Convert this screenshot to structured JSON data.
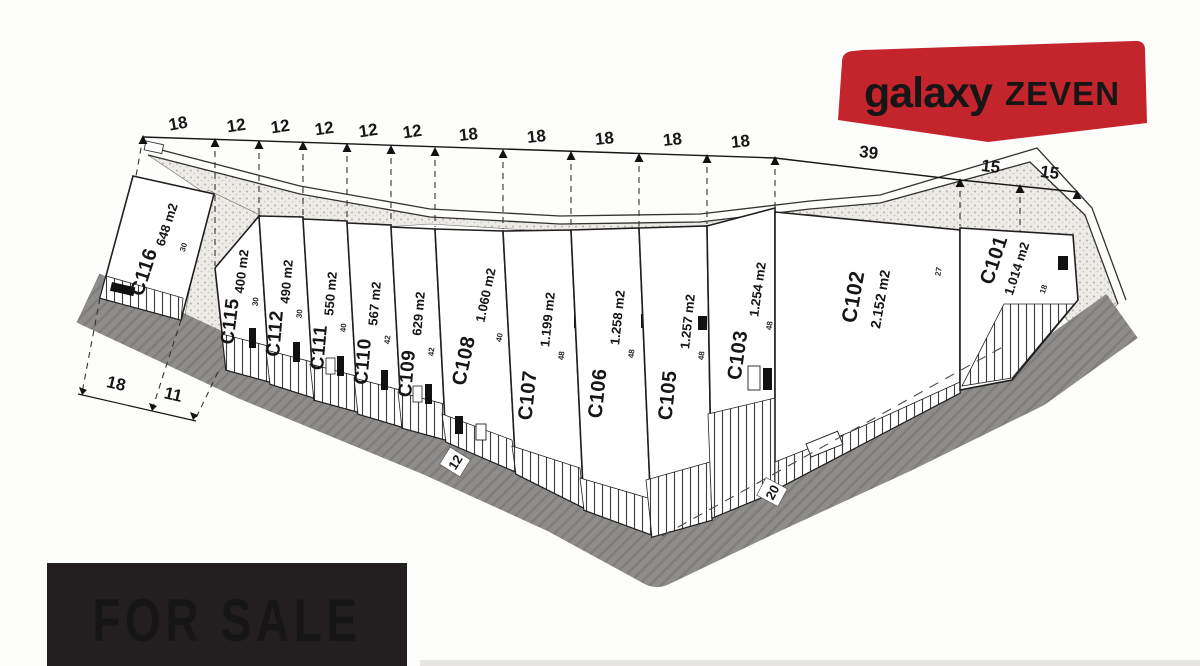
{
  "brand": {
    "name_primary": "galaxy",
    "name_secondary": "ZEVEN"
  },
  "sale_banner": {
    "text": "FOR SALE"
  },
  "dimensions": {
    "top": [
      "18",
      "12",
      "12",
      "12",
      "12",
      "12",
      "18",
      "18",
      "18",
      "18",
      "18",
      "39",
      "15",
      "15"
    ],
    "bottom_left": [
      "18",
      "11"
    ],
    "road": [
      "12",
      "20"
    ]
  },
  "lots": [
    {
      "id": "C116",
      "area": "648 m2",
      "frontage": "30"
    },
    {
      "id": "C115",
      "area": "400 m2",
      "frontage": "30"
    },
    {
      "id": "C112",
      "area": "490 m2",
      "frontage": "30"
    },
    {
      "id": "C111",
      "area": "550 m2",
      "frontage": "40"
    },
    {
      "id": "C110",
      "area": "567 m2",
      "frontage": "42"
    },
    {
      "id": "C109",
      "area": "629 m2",
      "frontage": "42"
    },
    {
      "id": "C108",
      "area": "1.060 m2",
      "frontage": "40"
    },
    {
      "id": "C107",
      "area": "1.199 m2",
      "frontage": "48"
    },
    {
      "id": "C106",
      "area": "1.258 m2",
      "frontage": "48"
    },
    {
      "id": "C105",
      "area": "1.257 m2",
      "frontage": "48"
    },
    {
      "id": "C103",
      "area": "1.254 m2",
      "frontage": "48"
    },
    {
      "id": "C102",
      "area": "2.152 m2",
      "frontage": "27"
    },
    {
      "id": "C101",
      "area": "1.014 m2",
      "frontage": "18"
    }
  ],
  "colors": {
    "banner_red": "#c4242b",
    "sale_bg": "#231f20",
    "ink": "#161616",
    "road_gray": "#8e8d8b"
  }
}
